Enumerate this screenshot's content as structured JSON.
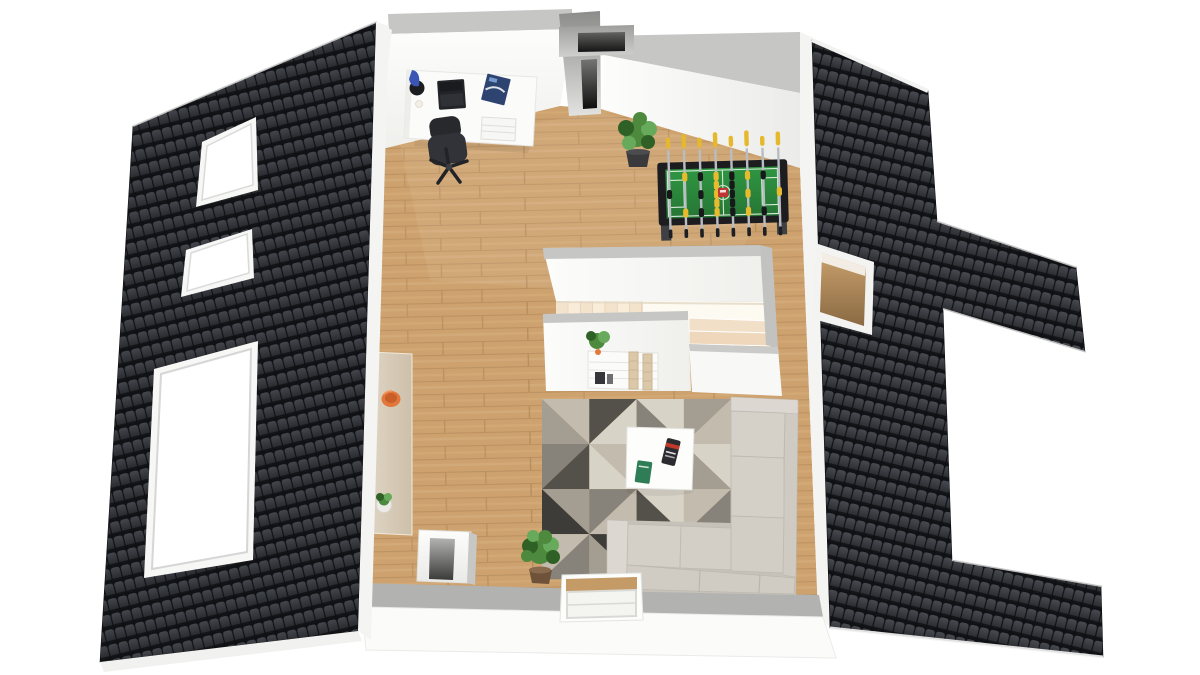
{
  "meta": {
    "type": "floorplan-3d-render",
    "view": "top-down attic level with pitched roofs"
  },
  "palette": {
    "background": "#ffffff",
    "roof_tile_dark": "#101114",
    "roof_tile_face": "#43464c",
    "roof_tile_face2": "#25272b",
    "roof_trim": "#f4f4f3",
    "wall_white": "#fafaf8",
    "wall_gray_top": "#c6c6c5",
    "wall_gray_band_bottom": "#b2b2b1",
    "floor_wood": "#cda26e",
    "floor_wood_dark": "#ae8557",
    "floor_wood_light": "#dcb788",
    "stair_step": "#f4e3cc",
    "stair_step_alt": "#f9edda",
    "stair_well": "#fdfaf1",
    "chimney_gray": "#9a9a99",
    "slot_dark": "#141414",
    "desk_white": "#fbfbfa",
    "chair_black": "#2e2f33",
    "laptop_black": "#232428",
    "lamp_blue": "#3a55b4",
    "magazine_navy": "#2e4470",
    "sofa_light": "#d5d1c9",
    "sofa_shade": "#c6c2ba",
    "sofa_arm": "#dcd8d1",
    "rug_light": "#d8d3c7",
    "rug_beige": "#c3bcae",
    "rug_taupe": "#a49e92",
    "rug_mid": "#87827a",
    "rug_dark": "#54514b",
    "rug_deep": "#3e3c38",
    "table_white": "#fdfdfc",
    "book_dark": "#2b2b30",
    "book_red": "#c0392b",
    "book_green": "#2f7d56",
    "plant_green": "#4e8a3e",
    "plant_green_dark": "#2f6127",
    "plant_green_light": "#67aa5b",
    "pot_dark": "#3a3a3c",
    "pot_brown": "#6e523a",
    "sideboard_tan": "#d7cab6",
    "bowl_orange": "#e2763b",
    "foosball_frame": "#1d1d20",
    "foosball_field": "#2e8b3d",
    "foosball_line": "#e4f2e4",
    "foosball_rod": "#b9bdc3",
    "foosball_handle": "#e6b82e",
    "foosball_player_black": "#17181a",
    "foosball_player_yellow": "#e8bb2f",
    "foosball_red": "#c23333",
    "window_frame": "#e9e9e7"
  },
  "objects": {
    "left_roof": {
      "label": "dark tiled roof slope left"
    },
    "right_roof": {
      "label": "dark tiled roof slope right"
    },
    "skylight_1": {
      "label": "roof window small upper"
    },
    "skylight_2": {
      "label": "roof window small middle"
    },
    "skylight_3": {
      "label": "roof window large lower"
    },
    "roof_opening": {
      "label": "open roof hatch right"
    },
    "desk": {
      "label": "white office desk"
    },
    "chair": {
      "label": "black office swivel chair"
    },
    "laptop": {
      "label": "laptop on desk"
    },
    "lamp": {
      "label": "blue desk lamp"
    },
    "magazine": {
      "label": "magazine on desk"
    },
    "drawers": {
      "label": "desk drawer unit"
    },
    "wall_plant": {
      "label": "potted plant at wall"
    },
    "foosball": {
      "label": "foosball table"
    },
    "staircase": {
      "label": "stairwell with L-shaped stairs"
    },
    "shelf": {
      "label": "white shelf with plant"
    },
    "sideboard": {
      "label": "tan sideboard with bowl"
    },
    "chimney_top": {
      "label": "chimney shaft top"
    },
    "chimney_low": {
      "label": "white chimney block"
    },
    "floor_plant": {
      "label": "green floor plant"
    },
    "rug": {
      "label": "geometric triangle rug"
    },
    "coffee_table": {
      "label": "white coffee table"
    },
    "sofa": {
      "label": "light gray corner sofa"
    },
    "dormer": {
      "label": "dormer window bottom"
    }
  },
  "rug": {
    "cols": 4,
    "rows": 4,
    "cells": [
      {
        "a": "rug_beige",
        "b": "rug_taupe",
        "d": 0
      },
      {
        "a": "rug_dark",
        "b": "rug_light",
        "d": 1
      },
      {
        "a": "rug_light",
        "b": "rug_mid",
        "d": 0
      },
      {
        "a": "rug_taupe",
        "b": "rug_beige",
        "d": 1
      },
      {
        "a": "rug_mid",
        "b": "rug_dark",
        "d": 1
      },
      {
        "a": "rug_beige",
        "b": "rug_light",
        "d": 0
      },
      {
        "a": "rug_deep",
        "b": "rug_beige",
        "d": 1
      },
      {
        "a": "rug_light",
        "b": "rug_taupe",
        "d": 0
      },
      {
        "a": "rug_taupe",
        "b": "rug_deep",
        "d": 0
      },
      {
        "a": "rug_mid",
        "b": "rug_beige",
        "d": 1
      },
      {
        "a": "rug_light",
        "b": "rug_dark",
        "d": 0
      },
      {
        "a": "rug_beige",
        "b": "rug_mid",
        "d": 1
      },
      {
        "a": "rug_beige",
        "b": "rug_mid",
        "d": 1
      },
      {
        "a": "rug_deep",
        "b": "rug_taupe",
        "d": 0
      },
      {
        "a": "rug_light",
        "b": "rug_beige",
        "d": 1
      },
      {
        "a": "rug_mid",
        "b": "rug_dark",
        "d": 0
      }
    ]
  },
  "foosball": {
    "rods": [
      {
        "players": 1,
        "team": "black",
        "handle": 11
      },
      {
        "players": 2,
        "team": "yellow",
        "handle": 14
      },
      {
        "players": 3,
        "team": "black",
        "handle": 10
      },
      {
        "players": 5,
        "team": "yellow",
        "handle": 15
      },
      {
        "players": 5,
        "team": "black",
        "handle": 11
      },
      {
        "players": 3,
        "team": "yellow",
        "handle": 16
      },
      {
        "players": 2,
        "team": "black",
        "handle": 10
      },
      {
        "players": 1,
        "team": "yellow",
        "handle": 14
      }
    ]
  },
  "stairs": {
    "upper_steps": 7,
    "lower_steps": 2
  }
}
